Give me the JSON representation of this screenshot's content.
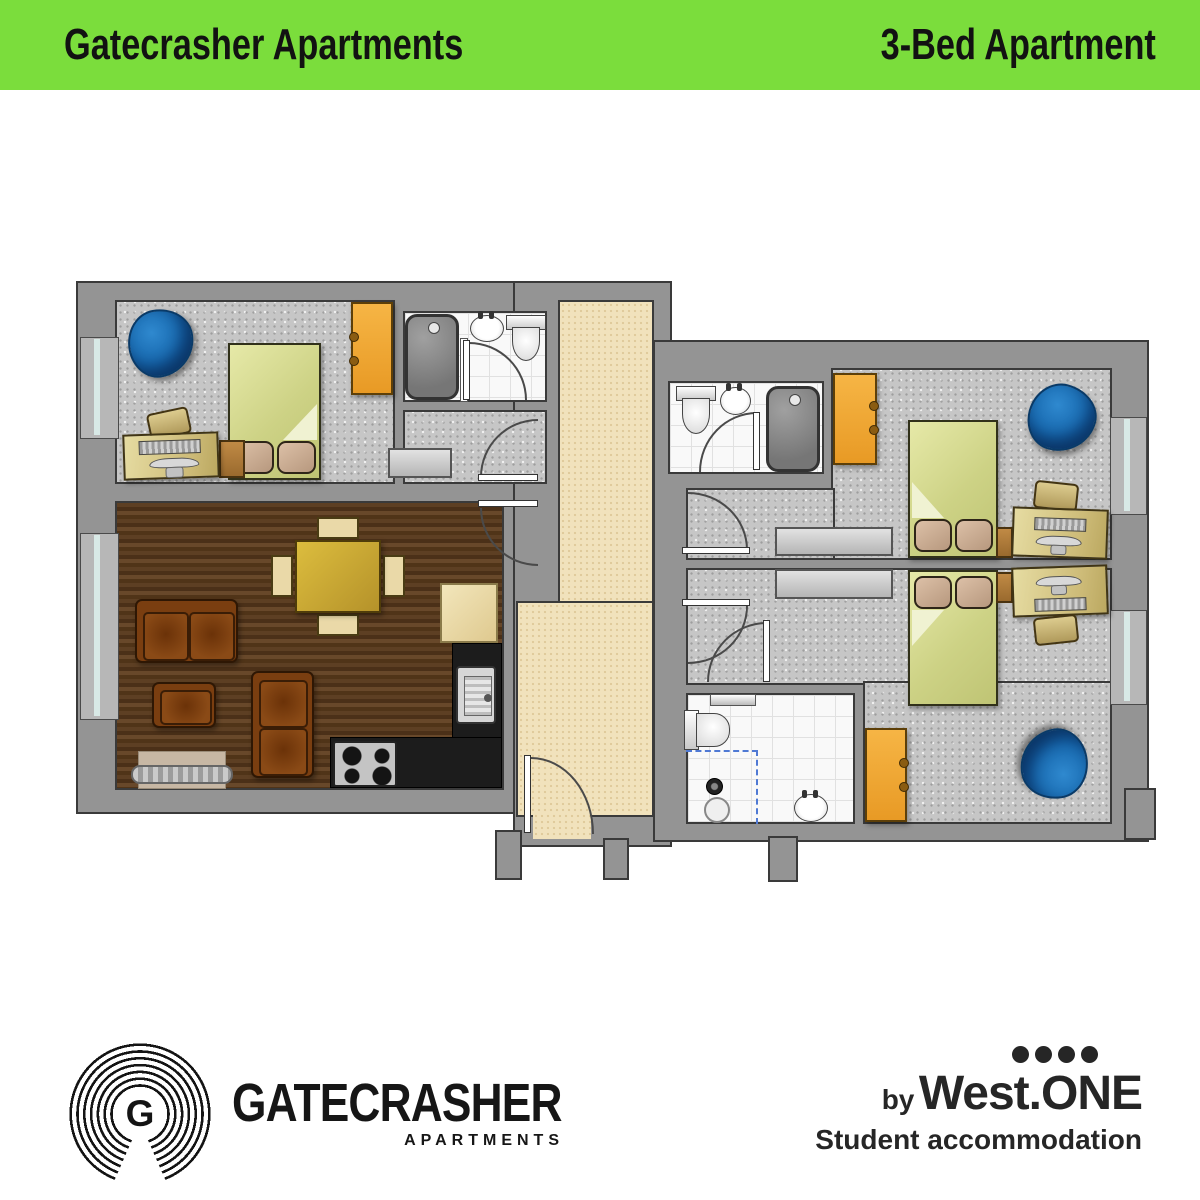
{
  "header": {
    "left_title": "Gatecrasher Apartments",
    "right_title": "3-Bed Apartment",
    "bg_color": "#7bdd3c",
    "text_color": "#121212"
  },
  "floorplan": {
    "colors": {
      "wall_gray": "#949494",
      "carpet_gray": "#c6c6c6",
      "wood_brown": "#53371e",
      "hallway_cream": "#f1e2bc",
      "tile_white": "#f9f9f9",
      "bed_green": "#d3d88b",
      "pillow_tan": "#c4a488",
      "wardrobe_orange": "#f0a832",
      "beanbag_blue": "#1d6cb0",
      "sofa_brown": "#7a3e10",
      "dining_table_gold": "#c9a72e",
      "kitchen_counter_black": "#1c1c1c",
      "window_stripe": "#d8e9e6",
      "shower_dash_blue": "#4f79d4"
    }
  },
  "footer": {
    "brand": {
      "monogram": "G",
      "wordmark": "GATECRASHER",
      "subtext": "APARTMENTS"
    },
    "westone": {
      "by": "by",
      "name": "West.ONE",
      "tagline": "Student accommodation",
      "dot_count": 4
    }
  }
}
